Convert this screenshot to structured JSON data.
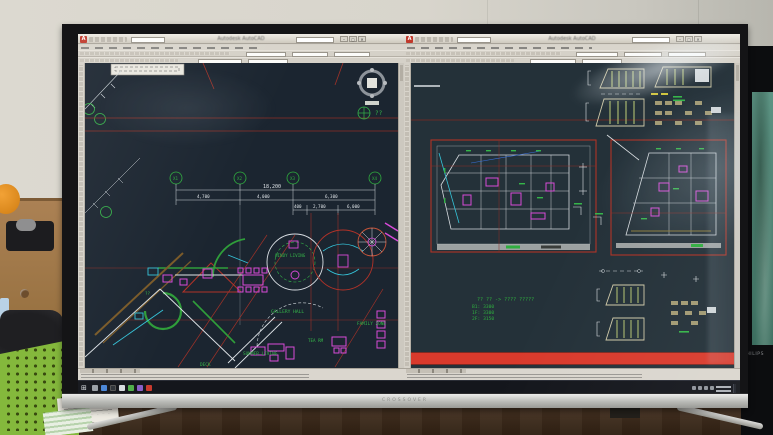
{
  "monitor": {
    "brand": "CROSSOVER"
  },
  "secondary_monitor": {
    "brand": "PHILIPS"
  },
  "left_window": {
    "title": "Autodesk AutoCAD",
    "grid_bubbles": [
      "X1",
      "X2",
      "X3",
      "X4"
    ],
    "dim_total": "18,200",
    "dims_row2": [
      "4,700",
      "4,000",
      "6,300"
    ],
    "dims_row3": [
      "400",
      "2,700",
      "6,000"
    ],
    "room_labels": {
      "windy_living": "WINDY LIVING",
      "gallery_hall": "GALLERY HALL",
      "family_zone": "FAMILY ZONE",
      "tea_room": "TEA RM",
      "summer_living": "SUMMER LIVING",
      "deck": "DECK"
    },
    "glyph_unknown": "??"
  },
  "right_window": {
    "title": "Autodesk AutoCAD",
    "annotation": {
      "line1": "?? ?? -> ???? ?????",
      "b1": "B1: 3300",
      "f1": "1F: 3300",
      "f2": "2F: 3150"
    }
  },
  "window_buttons": {
    "minimize": "–",
    "maximize": "▢",
    "close": "✕"
  },
  "taskbar": {
    "start_icon": "⊞",
    "app_icon_names": [
      "explorer-icon",
      "browser-icon",
      "dark-app-icon",
      "light-app-icon",
      "green-app-icon",
      "purple-app-icon",
      "autocad-icon"
    ],
    "tray_icon_names": [
      "chevron-icon",
      "network-icon",
      "volume-icon",
      "language-icon"
    ]
  },
  "colors": {
    "cad_green": "#35b549",
    "cad_magenta": "#d84ad8",
    "cad_red": "#b03226",
    "cad_cyan": "#35c3d8",
    "cad_white": "#dfe4e8",
    "highlight_red_bar": "#d93a2c",
    "canvas_left": "#1b2530",
    "canvas_right": "#243139",
    "basket_green": "#84b83c",
    "autocad_brand_red": "#c0392b"
  }
}
